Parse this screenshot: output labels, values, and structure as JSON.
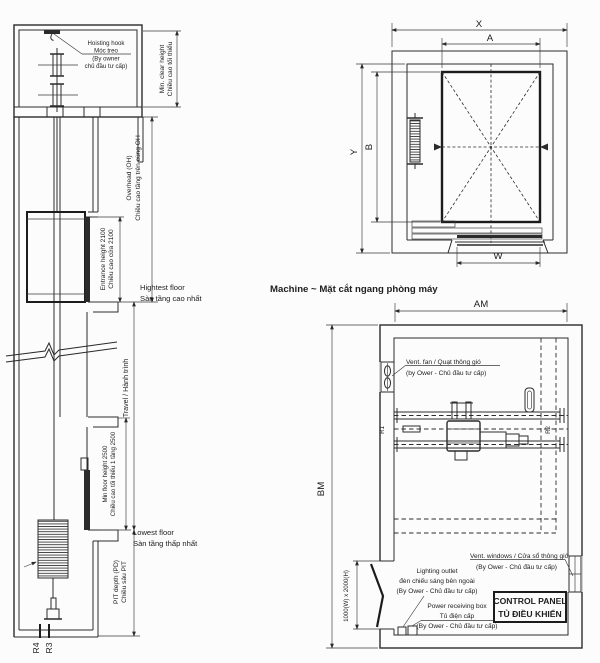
{
  "drawing": {
    "caption_machine_section": "Machine ~  Mặt cắt ngang phòng máy"
  },
  "elevation": {
    "hoisting_hook_label": [
      "Hoisting hook",
      "Móc treo",
      "(By owner",
      "chủ đầu tư cấp)"
    ],
    "min_clear_height": [
      "Min. clear height",
      "Chiều cao tối thiểu"
    ],
    "overhead": [
      "Overhead (OH)",
      "Chiều cao tầng trên cùng OH"
    ],
    "entrance_height": [
      "Entrance height 2100",
      "Chiều cao cửa 2100"
    ],
    "highest_floor": [
      "Hightest floor",
      "Sàn tầng cao nhất"
    ],
    "travel": "Travel / Hành trình",
    "min_floor_height": [
      "Min floor  height 2500",
      "Chiều cao tối thiểu 1 tầng 2500"
    ],
    "lowest_floor": [
      "Lowest floor",
      "Sàn tầng thấp nhất"
    ],
    "pit_depth": [
      "PIT depth (PD)",
      "Chiều sâu PIT"
    ],
    "rope_refs": [
      "R4",
      "R3"
    ]
  },
  "car_plan": {
    "dims": {
      "x": "X",
      "a": "A",
      "y": "Y",
      "b": "B",
      "w": "W"
    }
  },
  "machine_plan": {
    "dims": {
      "am": "AM",
      "bm": "BM",
      "door": "1000(W) x 2000(H)"
    },
    "rope_refs": [
      "R1",
      "R2"
    ],
    "vent_fan": [
      "Vent. fan / Quạt thông gió",
      "(by Ower - Chủ đầu tư cấp)"
    ],
    "vent_windows": [
      "Vent. windows / Cửa sổ thông gió",
      "(By Ower - Chủ đầu tư cấp)"
    ],
    "lighting_outlet": [
      "Lighting outlet",
      "đèn chiếu sáng bên ngoài",
      "(By Ower - Chủ đầu tư cấp)"
    ],
    "power_box": [
      "Power receiving box",
      "Tủ điện cấp",
      "(By Ower - Chủ đầu tư cấp)"
    ],
    "control_panel": [
      "CONTROL PANEL",
      "TỦ ĐIỀU KHIỂN"
    ]
  },
  "colors": {
    "line": "#2b2b2b",
    "background": "#fcfcfc"
  }
}
